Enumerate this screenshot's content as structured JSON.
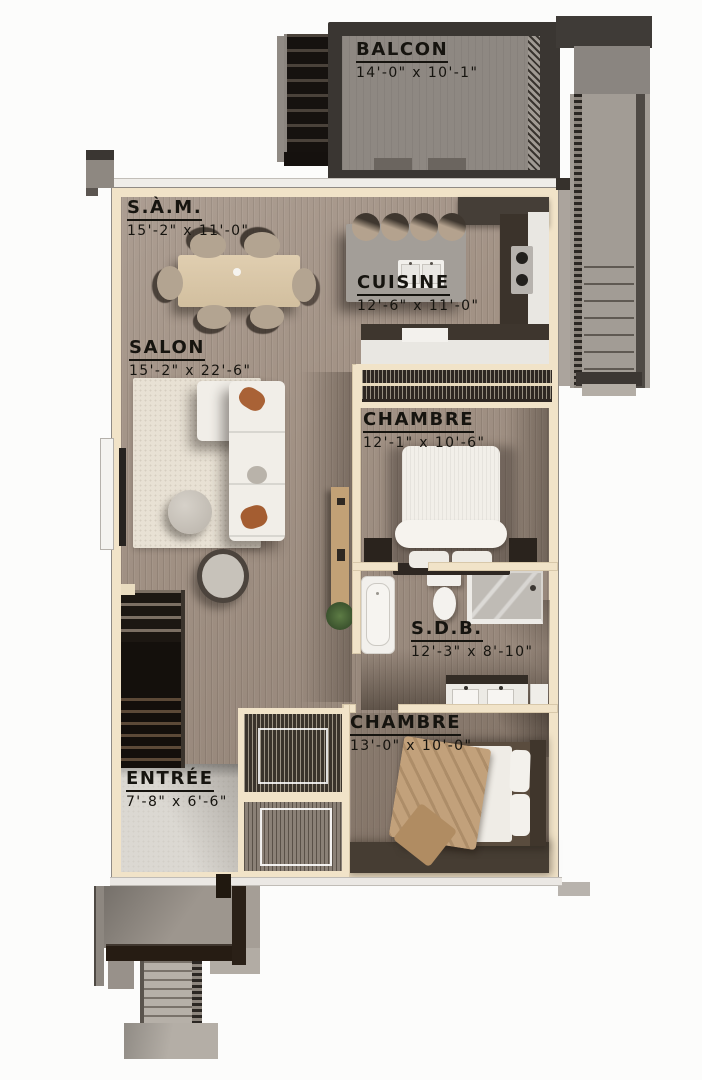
{
  "meta": {
    "type": "floor-plan",
    "style": "3d-top-down-render",
    "language": "fr"
  },
  "rooms": [
    {
      "id": "balcon",
      "name": "BALCON",
      "dims": "14'-0\" x 10'-1\""
    },
    {
      "id": "sam",
      "name": "S.À.M.",
      "dims": "15'-2\" x 11'-0\""
    },
    {
      "id": "cuisine",
      "name": "CUISINE",
      "dims": "12'-6\" x 11'-0\""
    },
    {
      "id": "salon",
      "name": "SALON",
      "dims": "15'-2\" x 22'-6\""
    },
    {
      "id": "chambre1",
      "name": "CHAMBRE",
      "dims": "12'-1\" x 10'-6\""
    },
    {
      "id": "sdb",
      "name": "S.D.B.",
      "dims": "12'-3\" x 8'-10\""
    },
    {
      "id": "chambre2",
      "name": "CHAMBRE",
      "dims": "13'-0\" x 10'-0\""
    },
    {
      "id": "entree",
      "name": "ENTRÉE",
      "dims": "7'-8\" x 6'-6\""
    }
  ],
  "colors": {
    "wall": "#f1e3c8",
    "floor_wood": "#a29285",
    "floor_wood_dark": "#8f8174",
    "deck_gray": "#8e8882",
    "deck_frame_dark": "#3a3632",
    "stair_dark": "#1b1613",
    "label_ink": "#16140f",
    "rug": "#e8e1d4",
    "sofa_white": "#f1eee8",
    "accent_pillow": "#a96236",
    "bed_blanket": "#c2a17b",
    "counter_dark": "#3b332b",
    "counter_white": "#e9e7e2",
    "entry_marble": "#dbd8d2",
    "porch_gray": "#9d968e",
    "railing_brown": "#261c13"
  }
}
